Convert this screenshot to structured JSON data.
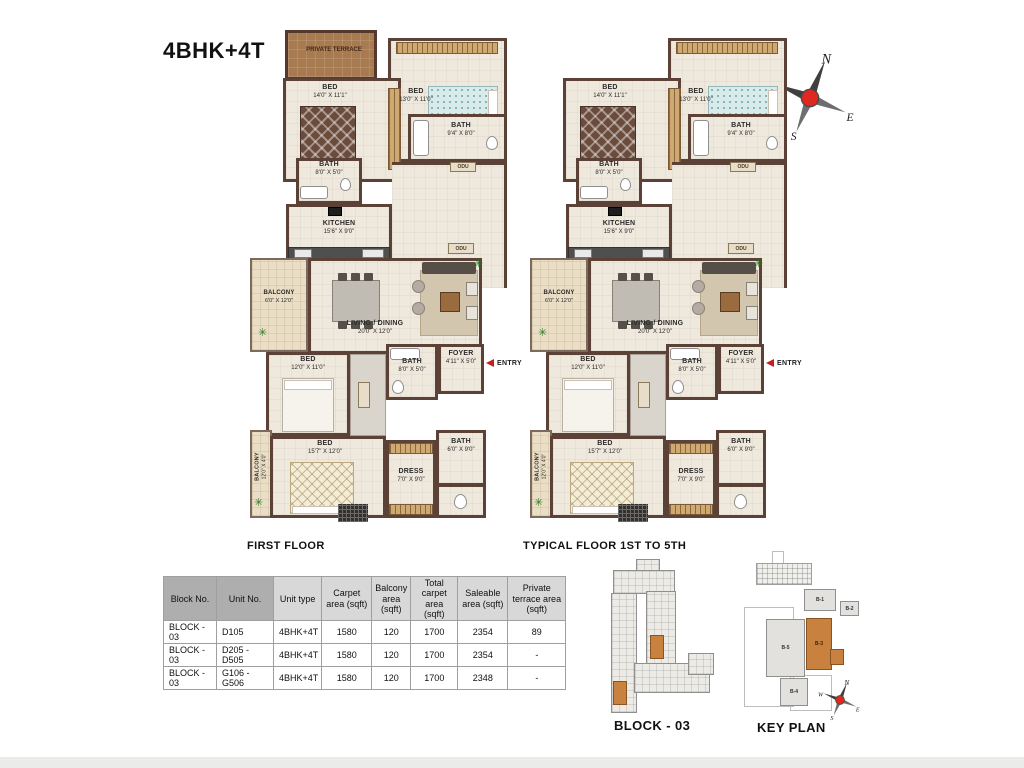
{
  "title": "4BHK+4T",
  "captions": {
    "left_plan": "FIRST FLOOR",
    "right_plan": "TYPICAL FLOOR 1ST TO 5TH",
    "block_plan": "BLOCK - 03",
    "key_plan": "KEY PLAN"
  },
  "compass": {
    "n": "N",
    "e": "E",
    "s": "S",
    "w": "W"
  },
  "rooms": {
    "terrace": {
      "name": "PRIVATE TERRACE"
    },
    "bed1": {
      "name": "BED",
      "dims": "14'0\" X 11'1\""
    },
    "bed2": {
      "name": "BED",
      "dims": "13'0\" X 11'0\""
    },
    "bath1": {
      "name": "BATH",
      "dims": "9'4\" X 8'0\""
    },
    "bath2": {
      "name": "BATH",
      "dims": "8'0\" X 5'0\""
    },
    "kitchen": {
      "name": "KITCHEN",
      "dims": "15'6\" X 9'0\""
    },
    "balcony1": {
      "name": "BALCONY",
      "dims": "6'0\" X 12'0\""
    },
    "living": {
      "name": "LIVING / DINING",
      "dims": "20'0\" X 12'0\""
    },
    "foyer": {
      "name": "FOYER",
      "dims": "4'11\" X 5'0\""
    },
    "entry": "ENTRY",
    "bed3": {
      "name": "BED",
      "dims": "12'0\" X 11'0\""
    },
    "bath3": {
      "name": "BATH",
      "dims": "8'0\" X 5'0\""
    },
    "bed4": {
      "name": "BED",
      "dims": "15'7\" X 12'0\""
    },
    "balcony2": {
      "name": "BALCONY",
      "dims": "12'0\" X 4'0\""
    },
    "dress": {
      "name": "DRESS",
      "dims": "7'0\" X 9'0\""
    },
    "bath4": {
      "name": "BATH",
      "dims": "6'0\" X 9'0\""
    },
    "odu": "ODU"
  },
  "table": {
    "headers": [
      "Block No.",
      "Unit No.",
      "Unit type",
      "Carpet area (sqft)",
      "Balcony area (sqft)",
      "Total carpet area (sqft)",
      "Saleable area (sqft)",
      "Private terrace area (sqft)"
    ],
    "rows": [
      [
        "BLOCK - 03",
        "D105",
        "4BHK+4T",
        "1580",
        "120",
        "1700",
        "2354",
        "89"
      ],
      [
        "BLOCK - 03",
        "D205 - D505",
        "4BHK+4T",
        "1580",
        "120",
        "1700",
        "2354",
        "-"
      ],
      [
        "BLOCK - 03",
        "G106 - G506",
        "4BHK+4T",
        "1580",
        "120",
        "1700",
        "2348",
        "-"
      ]
    ]
  },
  "key_plan": {
    "b1": "B-1",
    "b2": "B-2",
    "b3": "B-3",
    "b4": "B-4",
    "b5": "B-5"
  }
}
